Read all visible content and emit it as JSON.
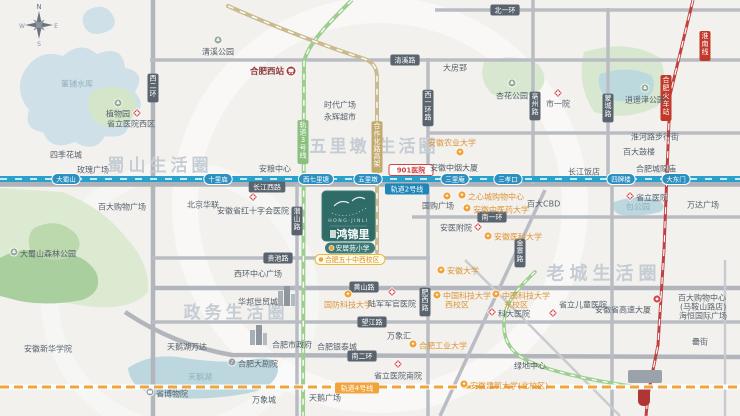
{
  "canvas": {
    "w": 740,
    "h": 416
  },
  "compass": {
    "n": "N",
    "e": "E",
    "s": "S",
    "w": "W"
  },
  "colors": {
    "metro_line2": "#2aa0cc",
    "metro_line4": "#f0a53c",
    "metro_line3": "#9ccf8f",
    "elevated_tan": "#c9ba90",
    "railway_red": "#c04040",
    "road_grey": "#b9bdc3",
    "road_label_bg": "#5a646e",
    "station_pill": "#2b8fc0",
    "metro2_pill": "#1f86b8",
    "poi_orange": "#efa33a",
    "poi_grey": "#9aa1a9",
    "hospital_red": "#d4494f",
    "park_green": "#dcead2",
    "park_dark": "#a9cf9f",
    "water_blue": "#cfe0e9",
    "lake_teal": "#bcd7de",
    "logo_teal": "#2f6b67",
    "watermark_grey": "#c5ccd3",
    "pill_yellow_border": "#e8b93e",
    "school_orange": "#d98f2a",
    "rail_label_bg": "#c0392b",
    "station_red_text": "#8b3a3a"
  },
  "project": {
    "zh": "鸿锦里",
    "en": "HONG·JINLI",
    "pills": [
      {
        "text": "安居苑小学",
        "style": "teal"
      },
      {
        "text": "合肥五十中西校区",
        "style": "yellow"
      }
    ]
  },
  "watermarks": [
    {
      "text": "蜀山生活圈",
      "x": 160,
      "y": 166,
      "size": 17,
      "ls": 4
    },
    {
      "text": "五里墩 生活圈",
      "x": 374,
      "y": 147,
      "size": 17,
      "ls": 3
    },
    {
      "text": "政务生活圈",
      "x": 236,
      "y": 313,
      "size": 17,
      "ls": 4
    },
    {
      "text": "老城生活圈",
      "x": 604,
      "y": 274,
      "size": 18,
      "ls": 5
    }
  ],
  "metro2": {
    "label": "轨道2号线",
    "y": 179,
    "stations": [
      {
        "n": "大蜀山",
        "x": 66
      },
      {
        "n": "十里庙",
        "x": 218
      },
      {
        "n": "西七里塘",
        "x": 316
      },
      {
        "n": "五里墩",
        "x": 368
      },
      {
        "n": "三里庵",
        "x": 455
      },
      {
        "n": "三孝口",
        "x": 508
      },
      {
        "n": "四牌楼",
        "x": 621
      },
      {
        "n": "大东门",
        "x": 676
      }
    ]
  },
  "roadLabels": [
    {
      "text": "清溪路",
      "x": 405,
      "y": 60,
      "style": "dark",
      "vert": false
    },
    {
      "text": "北一环",
      "x": 505,
      "y": 10,
      "style": "dark",
      "vert": false
    },
    {
      "text": "长江西路",
      "x": 267,
      "y": 187,
      "style": "dark",
      "vert": false
    },
    {
      "text": "黄山路",
      "x": 364,
      "y": 287,
      "style": "dark",
      "vert": false
    },
    {
      "text": "望江路",
      "x": 372,
      "y": 322,
      "style": "dark",
      "vert": false
    },
    {
      "text": "南二环",
      "x": 362,
      "y": 356,
      "style": "dark",
      "vert": false
    },
    {
      "text": "南一环",
      "x": 492,
      "y": 217,
      "style": "dark",
      "vert": false
    },
    {
      "text": "贵池路",
      "x": 278,
      "y": 258,
      "style": "dark",
      "vert": false
    },
    {
      "text": "西二环",
      "x": 153,
      "y": 88,
      "style": "dark",
      "vert": true
    },
    {
      "text": "西一环路",
      "x": 428,
      "y": 108,
      "style": "dark",
      "vert": true
    },
    {
      "text": "蒙城路",
      "x": 608,
      "y": 108,
      "style": "dark",
      "vert": true
    },
    {
      "text": "亳州路",
      "x": 535,
      "y": 106,
      "style": "dark",
      "vert": true
    },
    {
      "text": "潜山路",
      "x": 297,
      "y": 221,
      "style": "dark",
      "vert": true
    },
    {
      "text": "金寨路",
      "x": 520,
      "y": 253,
      "style": "dark",
      "vert": true
    },
    {
      "text": "肥西路",
      "x": 425,
      "y": 302,
      "style": "dark",
      "vert": true
    },
    {
      "text": "轨道3号线",
      "x": 303,
      "y": 142,
      "style": "green",
      "vert": true
    },
    {
      "text": "合作化路高架",
      "x": 377,
      "y": 147,
      "style": "tan",
      "vert": true
    },
    {
      "text": "轨道2号线",
      "x": 407,
      "y": 189,
      "style": "blue",
      "vert": false
    },
    {
      "text": "轨道4号线",
      "x": 357,
      "y": 388,
      "style": "orange",
      "vert": false
    },
    {
      "text": "901医院",
      "x": 411,
      "y": 170,
      "style": "redpill",
      "vert": false
    }
  ],
  "railLabels": [
    {
      "text": "淮南线",
      "x": 705,
      "y": 46
    },
    {
      "text": "合肥火车站",
      "x": 666,
      "y": 98
    }
  ],
  "pois": [
    {
      "t": "清溪公园",
      "icon": "tree",
      "ix": 218,
      "iy": 40,
      "x": 218,
      "y": 52,
      "a": "middle"
    },
    {
      "t": "董铺水库",
      "icon": "none",
      "ix": 0,
      "iy": 0,
      "x": 77,
      "y": 84,
      "a": "middle",
      "c": "water"
    },
    {
      "t": "植物园",
      "icon": "tree",
      "ix": 118,
      "iy": 103,
      "x": 118,
      "y": 114,
      "a": "middle"
    },
    {
      "t": "省立医院西区",
      "icon": "hospital",
      "ix": 137,
      "iy": 113,
      "x": 131,
      "y": 124,
      "a": "middle"
    },
    {
      "t": "四季花城",
      "icon": "grey",
      "ix": 44,
      "iy": 153,
      "x": 50,
      "y": 155,
      "a": "start"
    },
    {
      "t": "玫瑰广场",
      "icon": "grey",
      "ix": 71,
      "iy": 168,
      "x": 77,
      "y": 170,
      "a": "start"
    },
    {
      "t": "合肥西站",
      "icon": "train",
      "ix": 291,
      "iy": 71,
      "x": 284,
      "y": 72,
      "a": "end",
      "c": "maroon"
    },
    {
      "t": "大房郢",
      "icon": "grey",
      "ix": 437,
      "iy": 66,
      "x": 443,
      "y": 68,
      "a": "start"
    },
    {
      "t": "时代广场",
      "icon": "grey",
      "ix": 318,
      "iy": 103,
      "x": 324,
      "y": 105,
      "a": "start"
    },
    {
      "t": "永辉超市",
      "icon": "grey",
      "ix": 318,
      "iy": 115,
      "x": 324,
      "y": 117,
      "a": "start"
    },
    {
      "t": "杏花公园",
      "icon": "tree",
      "ix": 512,
      "iy": 83,
      "x": 512,
      "y": 96,
      "a": "middle"
    },
    {
      "t": "市一院",
      "icon": "hospital",
      "ix": 558,
      "iy": 93,
      "x": 558,
      "y": 104,
      "a": "middle"
    },
    {
      "t": "安徽农业大学",
      "icon": "orange",
      "ix": 460,
      "iy": 152,
      "x": 452,
      "y": 143,
      "a": "middle",
      "c": "o"
    },
    {
      "t": "安徽中烟大厦",
      "icon": "grey",
      "ix": 424,
      "iy": 166,
      "x": 430,
      "y": 168,
      "a": "start"
    },
    {
      "t": "安粮中心",
      "icon": "grey",
      "ix": 296,
      "iy": 174,
      "x": 291,
      "y": 169,
      "a": "end"
    },
    {
      "t": "淮河路步行街",
      "icon": "grey",
      "ix": 625,
      "iy": 135,
      "x": 631,
      "y": 137,
      "a": "start"
    },
    {
      "t": "百大鼓楼",
      "icon": "grey",
      "ix": 617,
      "iy": 150,
      "x": 623,
      "y": 152,
      "a": "start"
    },
    {
      "t": "合肥城隍庙",
      "icon": "grey",
      "ix": 630,
      "iy": 167,
      "x": 636,
      "y": 169,
      "a": "start"
    },
    {
      "t": "长江饭店",
      "icon": "grey",
      "ix": 562,
      "iy": 171,
      "x": 568,
      "y": 172,
      "a": "start"
    },
    {
      "t": "逍遥津公园",
      "icon": "tree",
      "ix": 645,
      "iy": 88,
      "x": 645,
      "y": 100,
      "a": "middle"
    },
    {
      "t": "百大购物广场",
      "icon": "grey",
      "ix": 122,
      "iy": 196,
      "x": 122,
      "y": 207,
      "a": "middle"
    },
    {
      "t": "北京华联",
      "icon": "grey",
      "ix": 203,
      "iy": 194,
      "x": 203,
      "y": 205,
      "a": "middle"
    },
    {
      "t": "安徽省红十字会医院",
      "icon": "hospital",
      "ix": 253,
      "iy": 197,
      "x": 253,
      "y": 211,
      "a": "middle"
    },
    {
      "t": "省立医院",
      "icon": "hospital",
      "ix": 630,
      "iy": 196,
      "x": 636,
      "y": 198,
      "a": "start"
    },
    {
      "t": "包公园",
      "icon": "none",
      "ix": 0,
      "iy": 0,
      "x": 638,
      "y": 207,
      "a": "middle",
      "c": "water"
    },
    {
      "t": "万达广场",
      "icon": "grey",
      "ix": 681,
      "iy": 200,
      "x": 687,
      "y": 205,
      "a": "start"
    },
    {
      "t": "国购广场",
      "icon": "orange",
      "ix": 447,
      "iy": 196,
      "x": 438,
      "y": 206,
      "a": "middle"
    },
    {
      "t": "之心城购物中心",
      "icon": "orange",
      "ix": 462,
      "iy": 195,
      "x": 468,
      "y": 197,
      "a": "start",
      "c": "o"
    },
    {
      "t": "安徽中医药大学",
      "icon": "orange",
      "ix": 467,
      "iy": 208,
      "x": 473,
      "y": 210,
      "a": "start",
      "c": "o"
    },
    {
      "t": "百大CBD",
      "icon": "grey",
      "ix": 521,
      "iy": 202,
      "x": 527,
      "y": 204,
      "a": "start"
    },
    {
      "t": "安医附院",
      "icon": "hospital",
      "ix": 478,
      "iy": 227,
      "x": 472,
      "y": 228,
      "a": "end"
    },
    {
      "t": "安徽医科大学",
      "icon": "orange",
      "ix": 488,
      "iy": 236,
      "x": 494,
      "y": 237,
      "a": "start",
      "c": "o"
    },
    {
      "t": "安徽大学",
      "icon": "orange",
      "ix": 441,
      "iy": 270,
      "x": 447,
      "y": 271,
      "a": "start",
      "c": "o"
    },
    {
      "t": "国防科技大学",
      "icon": "orange",
      "ix": 348,
      "iy": 294,
      "x": 348,
      "y": 305,
      "a": "middle",
      "c": "o"
    },
    {
      "t": "陆军军官医院",
      "icon": "hospital",
      "ix": 392,
      "iy": 292,
      "x": 392,
      "y": 304,
      "a": "middle"
    },
    {
      "t": "中国科技大学",
      "t2": "西校区",
      "icon": "orange",
      "ix": 437,
      "iy": 295,
      "x": 443,
      "y": 296,
      "a": "start",
      "c": "o"
    },
    {
      "t": "中国科技大学",
      "t2": "东校区",
      "icon": "orange",
      "ix": 496,
      "iy": 294,
      "x": 502,
      "y": 296,
      "a": "start",
      "c": "o"
    },
    {
      "t": "科大医院",
      "icon": "hospital",
      "ix": 492,
      "iy": 312,
      "x": 498,
      "y": 314,
      "a": "start"
    },
    {
      "t": "省立儿童医院",
      "icon": "hospital",
      "ix": 553,
      "iy": 313,
      "x": 559,
      "y": 305,
      "a": "start"
    },
    {
      "t": "安徽省高速大厦",
      "icon": "red",
      "ix": 657,
      "iy": 299,
      "x": 651,
      "y": 310,
      "a": "end"
    },
    {
      "t": "百大购物中心",
      "t2": "(马鞍山路店)",
      "icon": "grey",
      "ix": 672,
      "iy": 297,
      "x": 678,
      "y": 298,
      "a": "start"
    },
    {
      "t": "海恒国际广场",
      "icon": "grey",
      "ix": 673,
      "iy": 314,
      "x": 679,
      "y": 316,
      "a": "start"
    },
    {
      "t": "罍街",
      "icon": "grey",
      "ix": 686,
      "iy": 340,
      "x": 692,
      "y": 342,
      "a": "start"
    },
    {
      "t": "西环中心广场",
      "icon": "grey",
      "ix": 288,
      "iy": 273,
      "x": 282,
      "y": 274,
      "a": "end"
    },
    {
      "t": "华邦世贸城",
      "icon": "building",
      "ix": 284,
      "iy": 292,
      "x": 278,
      "y": 302,
      "a": "end"
    },
    {
      "t": "合肥市政府",
      "icon": "building",
      "ix": 256,
      "iy": 331,
      "x": 272,
      "y": 345,
      "a": "start"
    },
    {
      "t": "合肥银泰城",
      "icon": "grey",
      "ix": 311,
      "iy": 345,
      "x": 317,
      "y": 347,
      "a": "start"
    },
    {
      "t": "天鹅湖万达",
      "icon": "grey",
      "ix": 213,
      "iy": 346,
      "x": 207,
      "y": 347,
      "a": "end"
    },
    {
      "t": "合肥大剧院",
      "icon": "theater",
      "ix": 232,
      "iy": 362,
      "x": 238,
      "y": 364,
      "a": "start"
    },
    {
      "t": "天鹅湖",
      "icon": "none",
      "ix": 0,
      "iy": 0,
      "x": 200,
      "y": 377,
      "a": "middle",
      "c": "water"
    },
    {
      "t": "省博物院",
      "icon": "museum",
      "ix": 150,
      "iy": 392,
      "x": 156,
      "y": 394,
      "a": "start"
    },
    {
      "t": "万象城",
      "icon": "grey",
      "ix": 282,
      "iy": 399,
      "x": 276,
      "y": 400,
      "a": "end"
    },
    {
      "t": "天鹅广场",
      "icon": "grey",
      "ix": 303,
      "iy": 396,
      "x": 309,
      "y": 398,
      "a": "start"
    },
    {
      "t": "安徽新华学院",
      "icon": "grey",
      "ix": 44,
      "iy": 339,
      "x": 48,
      "y": 349,
      "a": "middle"
    },
    {
      "t": "大蜀山森林公园",
      "icon": "tree",
      "ix": 14,
      "iy": 252,
      "x": 20,
      "y": 254,
      "a": "start"
    },
    {
      "t": "合肥工业大学",
      "icon": "orange",
      "ix": 413,
      "iy": 344,
      "x": 419,
      "y": 346,
      "a": "start",
      "c": "o"
    },
    {
      "t": "万象汇",
      "icon": "grey",
      "ix": 417,
      "iy": 335,
      "x": 411,
      "y": 336,
      "a": "end"
    },
    {
      "t": "省立医院南院",
      "icon": "hospital",
      "ix": 398,
      "iy": 364,
      "x": 398,
      "y": 376,
      "a": "middle"
    },
    {
      "t": "绿地中心",
      "icon": "grey",
      "ix": 508,
      "iy": 364,
      "x": 514,
      "y": 366,
      "a": "start"
    },
    {
      "t": "安徽建筑大学(北校区)",
      "icon": "orange",
      "ix": 464,
      "iy": 384,
      "x": 470,
      "y": 386,
      "a": "start",
      "c": "o"
    }
  ]
}
